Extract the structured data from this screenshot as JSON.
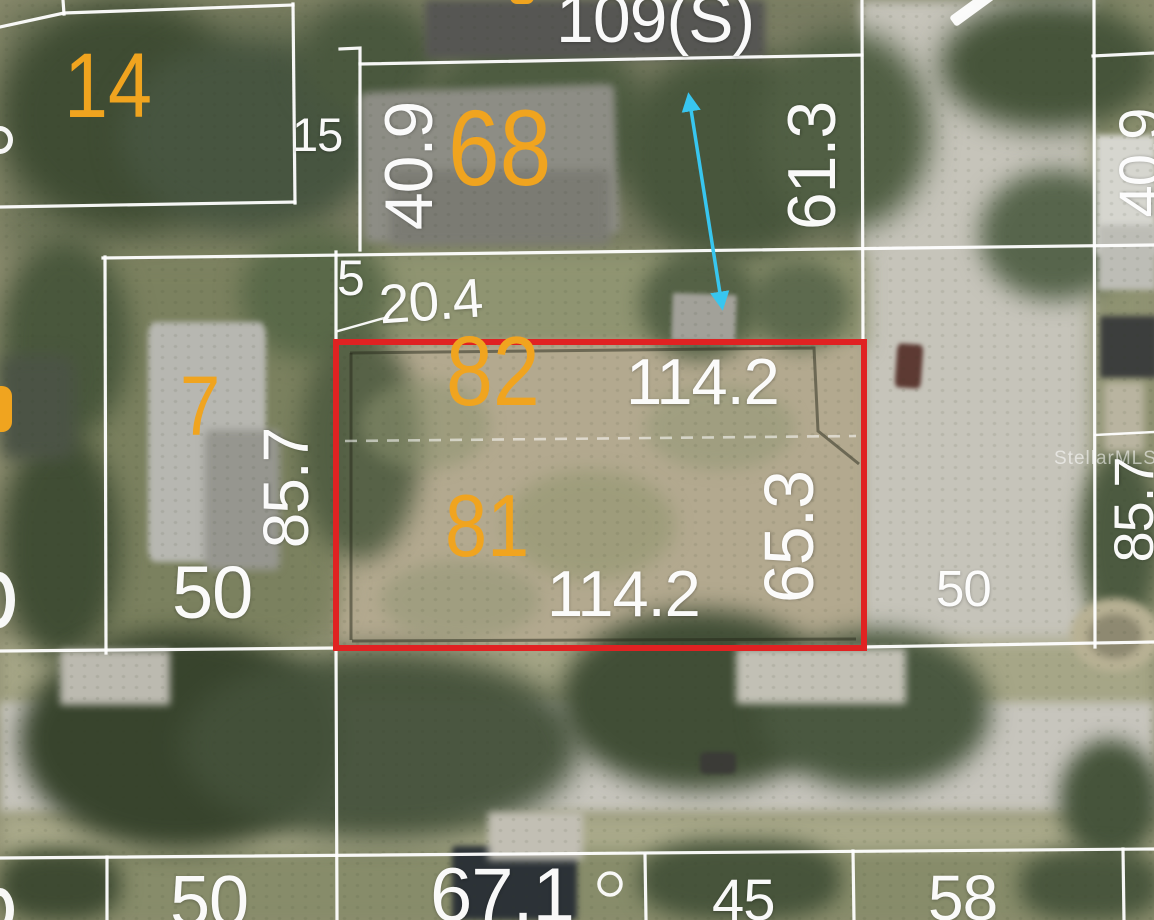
{
  "meta": {
    "type": "aerial-parcel-map-photo",
    "watermark": "StellarMLS"
  },
  "colors": {
    "parcel_number_text": "#f0a41f",
    "dimension_text": "#ffffff",
    "parcel_line": "#ffffff",
    "subject_outline": "#e02222",
    "pointer_arrow": "#38c6ef"
  },
  "parcel_numbers": {
    "p14": "14",
    "p68": "68",
    "p7": "7",
    "p82": "82",
    "p81": "81"
  },
  "dimensions": {
    "d109s": "109(S)",
    "d40_9_left": "40.9",
    "d61_3": "61.3",
    "d15": "15",
    "d5": "5",
    "d20_4": "20.4",
    "d114_2_top": "114.2",
    "d114_2_bottom": "114.2",
    "d85_7_left": "85.7",
    "d65_3": "65.3",
    "d50_left": "50",
    "d50_street": "50",
    "d85_7_right": "85.7",
    "d40_9_right": "40.9",
    "d50_bottom": "50",
    "d67_1": "67.1",
    "d45": "45",
    "d58": "58"
  },
  "subject_property": {
    "lot_numbers": [
      "82",
      "81"
    ],
    "frontage": "114.2",
    "depth": "65.3"
  },
  "watermark": "StellarMLS"
}
